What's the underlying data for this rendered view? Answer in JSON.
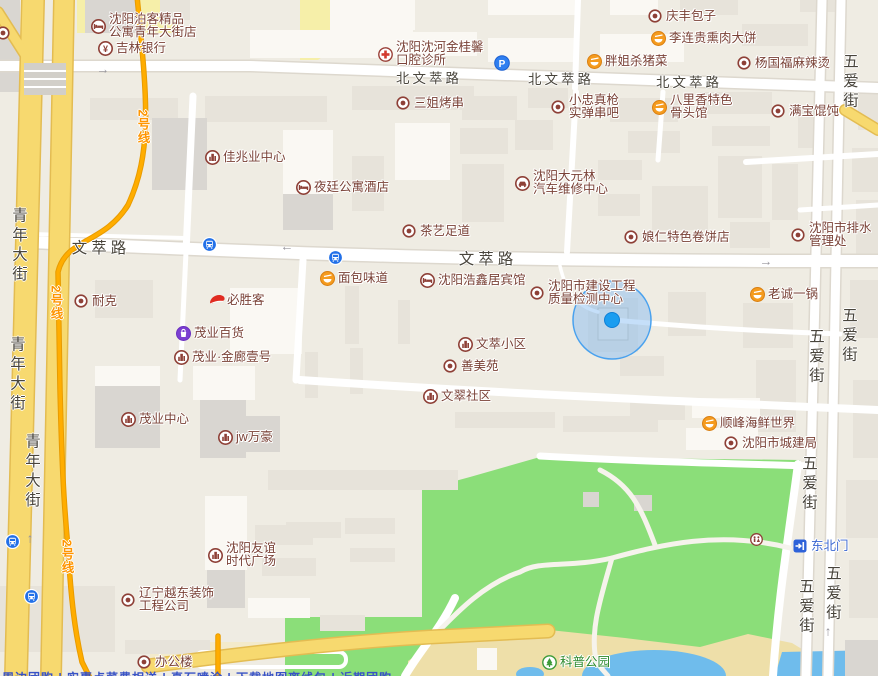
{
  "colors": {
    "road_yellow": "#F7D96F",
    "metro_line": "#FFAD00",
    "park_green": "#8BDE79",
    "water_blue": "#6FBCEC",
    "poi_text": "#7A4237",
    "street_text": "#49453C",
    "location_blue": "#1B9DF0",
    "park_sand": "#EEDFA9"
  },
  "pois": [
    {
      "id": "boke-boutique-apartment",
      "type": "hotel",
      "x": 98,
      "y": 26,
      "lines": [
        "沈阳泊客精品",
        "公寓青年大街店"
      ]
    },
    {
      "id": "jilin-bank",
      "type": "bank",
      "x": 105,
      "y": 48,
      "lines": [
        "吉林银行"
      ]
    },
    {
      "id": "jinguixin-dental-clinic",
      "type": "clinic",
      "x": 385,
      "y": 54,
      "lines": [
        "沈阳沈河金桂馨",
        "口腔诊所"
      ]
    },
    {
      "id": "parking-lot",
      "type": "parking",
      "x": 501,
      "y": 62,
      "lines": []
    },
    {
      "id": "pangjie-pork",
      "type": "food",
      "x": 594,
      "y": 61,
      "lines": [
        "胖姐杀猪菜"
      ]
    },
    {
      "id": "qingfeng-baozi",
      "type": "dot",
      "x": 655,
      "y": 16,
      "lines": [
        "庆丰包子"
      ]
    },
    {
      "id": "lilianggui-smoked-bing",
      "type": "food",
      "x": 658,
      "y": 38,
      "lines": [
        "李连贵熏肉大饼"
      ]
    },
    {
      "id": "yangguofu-malatang",
      "type": "dot",
      "x": 744,
      "y": 63,
      "lines": [
        "杨国福麻辣烫"
      ]
    },
    {
      "id": "sanjie-bbq",
      "type": "dot",
      "x": 403,
      "y": 103,
      "lines": [
        "三姐烤串"
      ]
    },
    {
      "id": "xiaozhong-chuanba",
      "type": "dot",
      "x": 558,
      "y": 107,
      "lines": [
        "小忠真枪",
        "实弹串吧"
      ]
    },
    {
      "id": "balixiang-bone-restaurant",
      "type": "food",
      "x": 659,
      "y": 107,
      "lines": [
        "八里香特色",
        "骨头馆"
      ]
    },
    {
      "id": "manbao-wonton",
      "type": "dot",
      "x": 778,
      "y": 111,
      "lines": [
        "满宝馄饨"
      ]
    },
    {
      "id": "jiazhaoye-center",
      "type": "building",
      "x": 212,
      "y": 157,
      "lines": [
        "佳兆业中心"
      ]
    },
    {
      "id": "yeting-apartment-hotel",
      "type": "hotel",
      "x": 303,
      "y": 187,
      "lines": [
        "夜廷公寓酒店"
      ]
    },
    {
      "id": "dayuanlin-auto-repair",
      "type": "car",
      "x": 522,
      "y": 183,
      "lines": [
        "沈阳大元林",
        "汽车维修中心"
      ]
    },
    {
      "id": "chayi-foot-massage",
      "type": "dot",
      "x": 409,
      "y": 231,
      "lines": [
        "茶艺足道"
      ]
    },
    {
      "id": "niangren-juanbing",
      "type": "dot",
      "x": 631,
      "y": 237,
      "lines": [
        "娘仁特色卷饼店"
      ]
    },
    {
      "id": "drainage-admin-office",
      "type": "dot",
      "x": 798,
      "y": 235,
      "lines": [
        "沈阳市排水",
        "管理处"
      ]
    },
    {
      "id": "mianbao-weidao-bakery",
      "type": "food",
      "x": 327,
      "y": 278,
      "lines": [
        "面包味道"
      ]
    },
    {
      "id": "haoxinju-hotel",
      "type": "hotel",
      "x": 427,
      "y": 280,
      "lines": [
        "沈阳浩鑫居宾馆"
      ]
    },
    {
      "id": "construction-quality-testing-center",
      "type": "dot",
      "x": 537,
      "y": 293,
      "lines": [
        "沈阳市建设工程",
        "质量检测中心"
      ]
    },
    {
      "id": "laocheng-yiguo",
      "type": "food",
      "x": 757,
      "y": 294,
      "lines": [
        "老诚一锅"
      ]
    },
    {
      "id": "nike",
      "type": "dot",
      "x": 81,
      "y": 301,
      "lines": [
        "耐克"
      ]
    },
    {
      "id": "pizza-hut",
      "type": "pizzahut",
      "x": 216,
      "y": 300,
      "lines": [
        "必胜客"
      ]
    },
    {
      "id": "maoye-department-store",
      "type": "shopping",
      "x": 183,
      "y": 333,
      "lines": [
        "茂业百货"
      ]
    },
    {
      "id": "maoye-jinlang-no1",
      "type": "building",
      "x": 181,
      "y": 357,
      "lines": [
        "茂业·金廊壹号"
      ]
    },
    {
      "id": "wencui-xiaoqu",
      "type": "building",
      "x": 465,
      "y": 344,
      "lines": [
        "文萃小区"
      ]
    },
    {
      "id": "shanmeiyuan",
      "type": "dot",
      "x": 450,
      "y": 366,
      "lines": [
        "善美苑"
      ]
    },
    {
      "id": "wencui-shequ",
      "type": "building",
      "x": 430,
      "y": 396,
      "lines": [
        "文翠社区"
      ]
    },
    {
      "id": "maoye-center",
      "type": "building",
      "x": 128,
      "y": 419,
      "lines": [
        "茂业中心"
      ]
    },
    {
      "id": "jw-marriott",
      "type": "building",
      "x": 225,
      "y": 437,
      "lines": [
        "jw万豪"
      ]
    },
    {
      "id": "shunfeng-seafood-world",
      "type": "food",
      "x": 709,
      "y": 423,
      "lines": [
        "顺峰海鲜世界"
      ]
    },
    {
      "id": "urban-construction-bureau",
      "type": "dot",
      "x": 731,
      "y": 443,
      "lines": [
        "沈阳市城建局"
      ]
    },
    {
      "id": "youyi-times-plaza",
      "type": "building",
      "x": 215,
      "y": 555,
      "lines": [
        "沈阳友谊",
        "时代广场"
      ]
    },
    {
      "id": "yuedong-decoration-co",
      "type": "dot",
      "x": 128,
      "y": 600,
      "lines": [
        "辽宁越东装饰",
        "工程公司"
      ]
    },
    {
      "id": "office-building",
      "type": "dot",
      "x": 144,
      "y": 662,
      "lines": [
        "办公楼"
      ]
    },
    {
      "id": "kepu-park",
      "type": "park",
      "x": 549,
      "y": 662,
      "lines": [
        "科普公园"
      ],
      "color": "green"
    },
    {
      "id": "northeast-gate",
      "type": "gate",
      "x": 800,
      "y": 546,
      "lines": [
        "东北门"
      ],
      "color": "blue"
    },
    {
      "id": "park-restroom",
      "type": "restroom",
      "x": 757,
      "y": 540,
      "lines": []
    },
    {
      "id": "edge-poi",
      "type": "dot",
      "x": 3,
      "y": 33,
      "lines": []
    }
  ],
  "street_labels": [
    {
      "text": "北文萃路",
      "x": 429,
      "y": 77,
      "orient": "h",
      "size": "md"
    },
    {
      "text": "北文萃路",
      "x": 561,
      "y": 78,
      "orient": "h",
      "size": "md"
    },
    {
      "text": "北文萃路",
      "x": 689,
      "y": 81,
      "orient": "h",
      "size": "md"
    },
    {
      "text": "文萃路",
      "x": 101,
      "y": 247,
      "orient": "h",
      "size": "lg"
    },
    {
      "text": "文萃路",
      "x": 488,
      "y": 258,
      "orient": "h",
      "size": "lg"
    },
    {
      "text": "青年大街",
      "x": 18,
      "y": 246,
      "orient": "v",
      "size": "md"
    },
    {
      "text": "青年大街",
      "x": 16,
      "y": 375,
      "orient": "v",
      "size": "md"
    },
    {
      "text": "青年大街",
      "x": 31,
      "y": 472,
      "orient": "v",
      "size": "md"
    },
    {
      "text": "五爱街",
      "x": 849,
      "y": 82,
      "orient": "v",
      "size": "md"
    },
    {
      "text": "五爱街",
      "x": 848,
      "y": 336,
      "orient": "v",
      "size": "md"
    },
    {
      "text": "五爱街",
      "x": 815,
      "y": 357,
      "orient": "v",
      "size": "md"
    },
    {
      "text": "五爱街",
      "x": 808,
      "y": 484,
      "orient": "v",
      "size": "md"
    },
    {
      "text": "五爱街",
      "x": 805,
      "y": 607,
      "orient": "v",
      "size": "md"
    },
    {
      "text": "五爱街",
      "x": 832,
      "y": 594,
      "orient": "v",
      "size": "md"
    }
  ],
  "metro_labels": [
    {
      "text": "2号线",
      "x": 143,
      "y": 127
    },
    {
      "text": "2号线",
      "x": 56,
      "y": 303
    },
    {
      "text": "2号线",
      "x": 67,
      "y": 557
    }
  ],
  "transit_stops": [
    {
      "x": 209,
      "y": 244
    },
    {
      "x": 335,
      "y": 257
    },
    {
      "x": 12,
      "y": 541
    },
    {
      "x": 31,
      "y": 596
    }
  ],
  "arrows": [
    {
      "glyph": "→",
      "x": 103,
      "y": 69
    },
    {
      "glyph": "←",
      "x": 287,
      "y": 246
    },
    {
      "glyph": "→",
      "x": 766,
      "y": 261
    },
    {
      "glyph": "↑",
      "x": 30,
      "y": 538
    },
    {
      "glyph": "↑",
      "x": 828,
      "y": 631
    }
  ],
  "location_marker": {
    "x": 612,
    "y": 320,
    "radius": 39
  },
  "footer": {
    "partial_text": "周边团购 | 实惠点菜费相送 | 真石喷涂 | 下载地图离线包 | 近期团购"
  }
}
